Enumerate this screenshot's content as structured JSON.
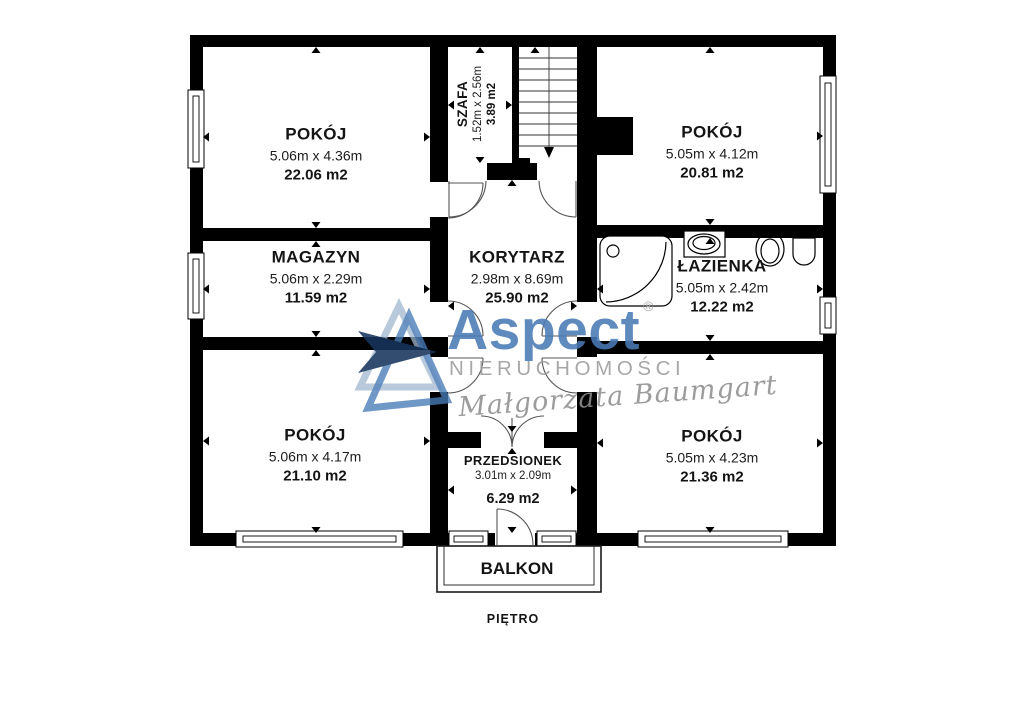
{
  "floor_plan": {
    "floor_label": "PIĘTRO",
    "balcony_label": "BALKON",
    "rooms": [
      {
        "id": "pokoj-top-left",
        "name": "POKÓJ",
        "dimensions": "5.06m x 4.36m",
        "area": "22.06 m2"
      },
      {
        "id": "szafa",
        "name": "SZAFA",
        "dimensions": "1.52m x 2.56m",
        "area": "3.89 m2"
      },
      {
        "id": "pokoj-top-right",
        "name": "POKÓJ",
        "dimensions": "5.05m x 4.12m",
        "area": "20.81 m2"
      },
      {
        "id": "magazyn",
        "name": "MAGAZYN",
        "dimensions": "5.06m x 2.29m",
        "area": "11.59 m2"
      },
      {
        "id": "korytarz",
        "name": "KORYTARZ",
        "dimensions": "2.98m x 8.69m",
        "area": "25.90 m2"
      },
      {
        "id": "lazienka",
        "name": "ŁAZIENKA",
        "dimensions": "5.05m x 2.42m",
        "area": "12.22 m2"
      },
      {
        "id": "pokoj-bottom-left",
        "name": "POKÓJ",
        "dimensions": "5.06m x 4.17m",
        "area": "21.10 m2"
      },
      {
        "id": "przedsionek",
        "name": "PRZEDSIONEK",
        "dimensions": "3.01m x 2.09m",
        "area": "6.29 m2"
      },
      {
        "id": "pokoj-bottom-right",
        "name": "POKÓJ",
        "dimensions": "5.05m x 4.23m",
        "area": "21.36 m2"
      }
    ]
  },
  "watermark": {
    "brand": "Aspect",
    "registered_mark": "®",
    "subtitle": "NIERUCHOMOŚCI",
    "signature": "Małgorzata Baumgart",
    "colors": {
      "brand_blue": "#4a7ab5",
      "triangle_dark": "#16355c",
      "triangle_medium": "#4a7cb8",
      "triangle_light": "#9fb7ce",
      "subtitle_gray": "#9b9b9b",
      "signature_gray": "#8f8f8f",
      "wall_black": "#000000"
    }
  }
}
